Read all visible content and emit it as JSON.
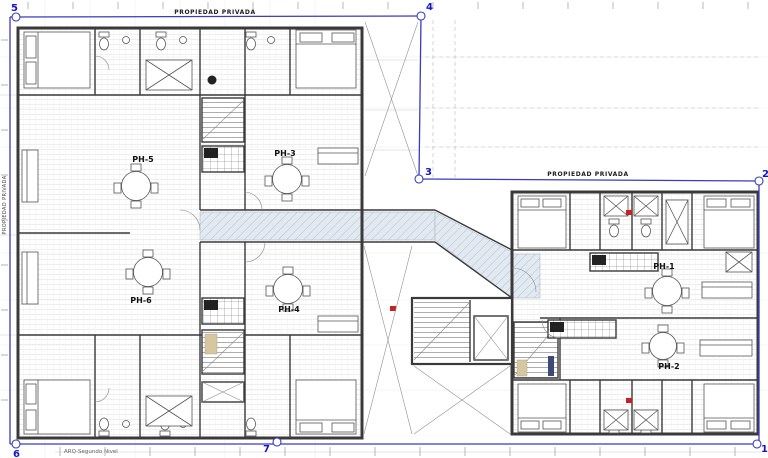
{
  "plan": {
    "footer_label": "ARQ-Segundo Nivel",
    "boundary_label_top": "PROPIEDAD PRIVADA",
    "boundary_label_right": "PROPIEDAD PRIVADA",
    "boundary_label_left": "PROPIEDAD PRIVADA"
  },
  "markers": [
    {
      "label": "1"
    },
    {
      "label": "2"
    },
    {
      "label": "3"
    },
    {
      "label": "4"
    },
    {
      "label": "5"
    },
    {
      "label": "6"
    },
    {
      "label": "7"
    }
  ],
  "units": [
    {
      "label": "PH-1"
    },
    {
      "label": "PH-2"
    },
    {
      "label": "PH-3"
    },
    {
      "label": "PH-4"
    },
    {
      "label": "PH-5"
    },
    {
      "label": "PH-6"
    }
  ],
  "colors": {
    "boundary": "#3a3ac0",
    "marker": "#1414cf",
    "wall": "#3a3a3a",
    "hatch-line": "#a7b8cb",
    "hatch-fill": "#e2e9f0",
    "red": "#cc2020",
    "beige": "#d8c79e"
  }
}
